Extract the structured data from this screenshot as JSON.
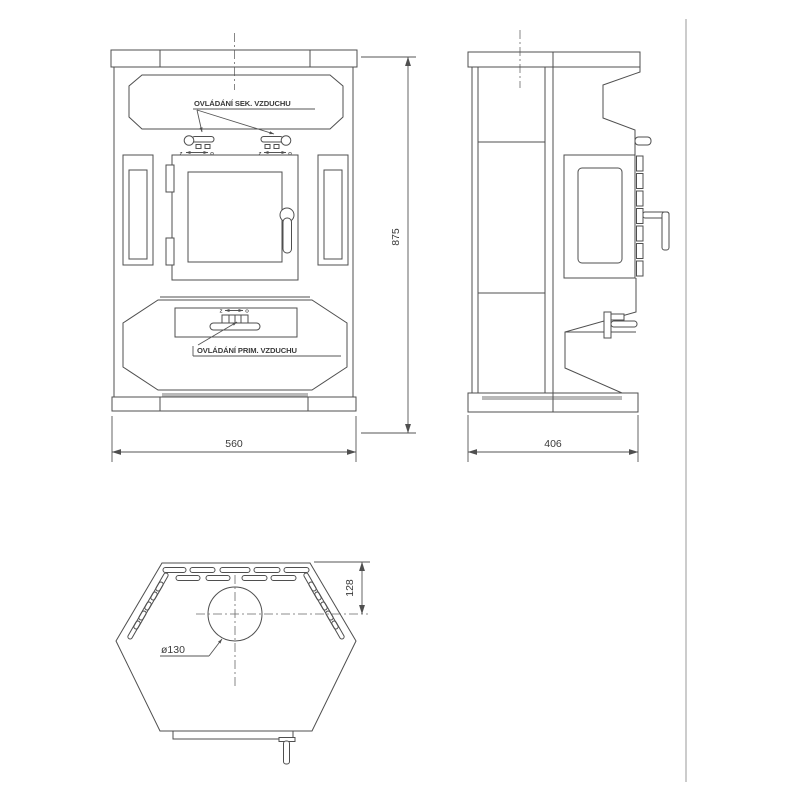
{
  "labels": {
    "secondary_air": "OVLÁDÁNÍ SEK. VZDUCHU",
    "primary_air": "OVLÁDÁNÍ PRIM. VZDUCHU",
    "closed_mark": "Z",
    "open_mark": "O"
  },
  "dimensions": {
    "overall_height": "875",
    "overall_width": "560",
    "overall_depth": "406",
    "flue_offset_from_front_edge": "128",
    "flue_diameter": "ø130"
  },
  "colors": {
    "line": "#4f4f4f",
    "text": "#3a3a3a",
    "shade": "#b9b9b9",
    "background": "#ffffff",
    "page_border": "#9a9a9a"
  }
}
